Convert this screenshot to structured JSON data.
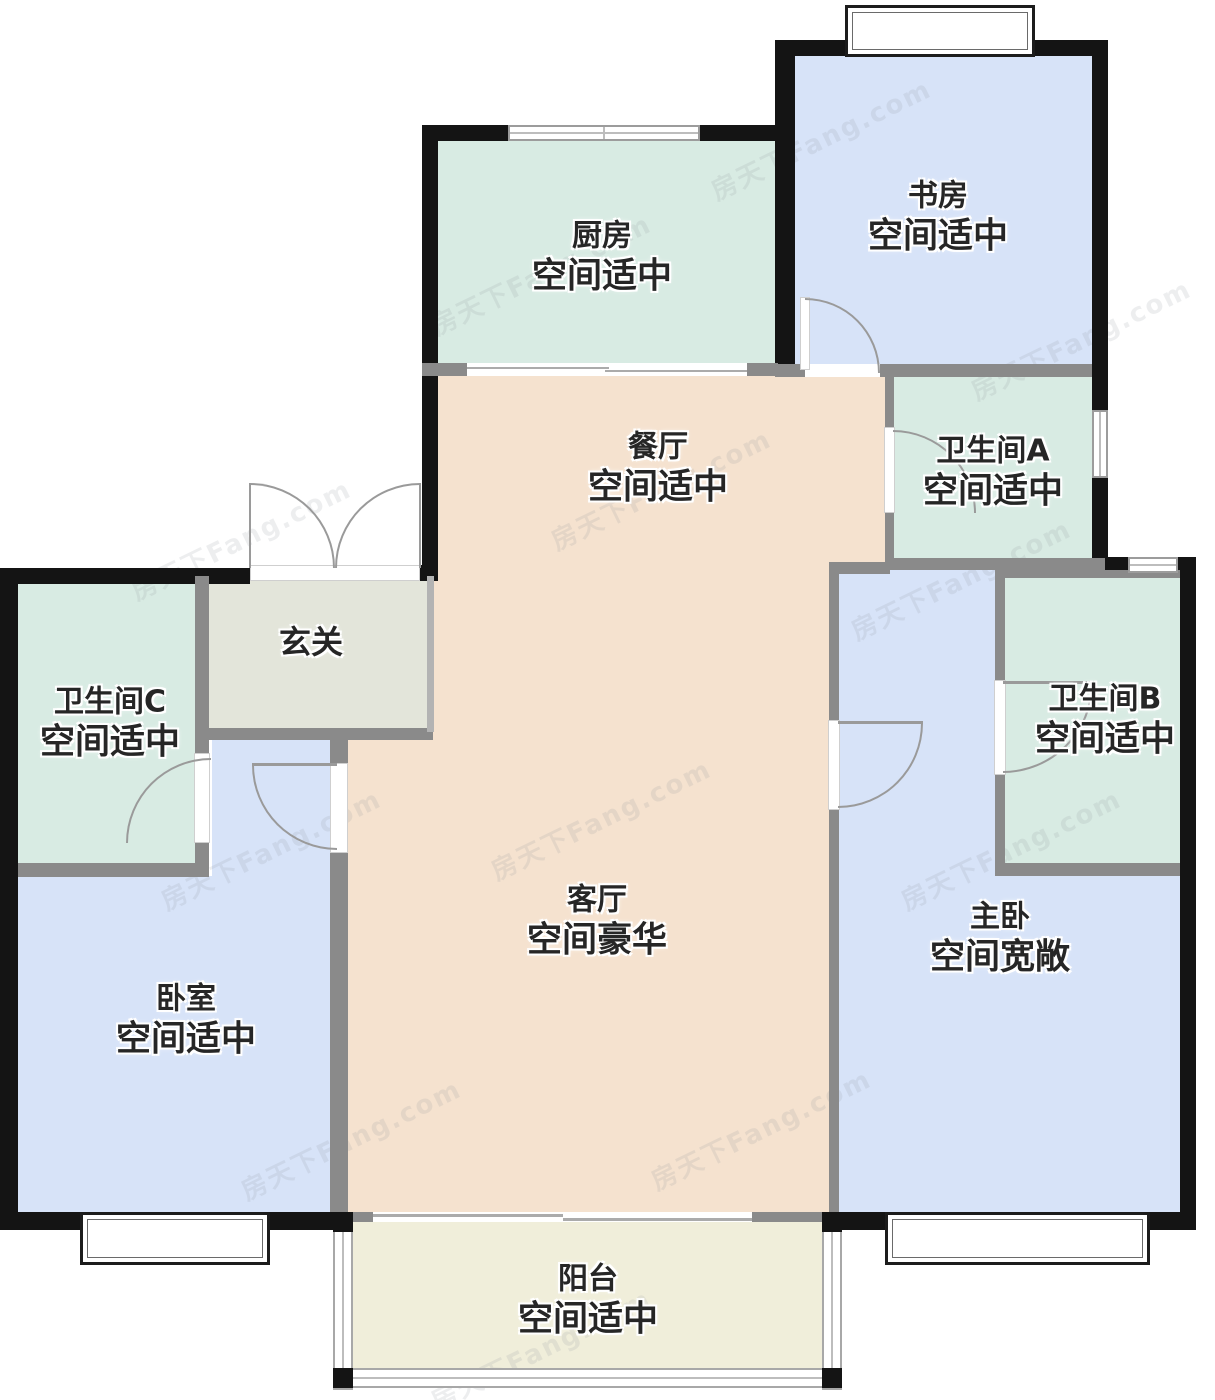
{
  "watermark": {
    "text": "房天下Fang.com"
  },
  "rooms": [
    {
      "id": "kitchen",
      "name": "厨房",
      "desc": "空间适中"
    },
    {
      "id": "study",
      "name": "书房",
      "desc": "空间适中"
    },
    {
      "id": "dining",
      "name": "餐厅",
      "desc": "空间适中"
    },
    {
      "id": "bathroom-a",
      "name": "卫生间A",
      "desc": "空间适中"
    },
    {
      "id": "entry",
      "name": "玄关",
      "desc": ""
    },
    {
      "id": "bathroom-c",
      "name": "卫生间C",
      "desc": "空间适中"
    },
    {
      "id": "bathroom-b",
      "name": "卫生间B",
      "desc": "空间适中"
    },
    {
      "id": "living",
      "name": "客厅",
      "desc": "空间豪华"
    },
    {
      "id": "bedroom",
      "name": "卧室",
      "desc": "空间适中"
    },
    {
      "id": "master",
      "name": "主卧",
      "desc": "空间宽敞"
    },
    {
      "id": "balcony",
      "name": "阳台",
      "desc": "空间适中"
    }
  ],
  "colors": {
    "teal": "#d8ebe3",
    "blue": "#d7e3f8",
    "beige": "#f5e2cf",
    "entry_gray": "#e3e5da",
    "balcony_cream": "#f0eeda",
    "wall_black": "#141414",
    "wall_gray": "#8a8a8a",
    "label": "#262626",
    "watermark": "#8a9099"
  }
}
